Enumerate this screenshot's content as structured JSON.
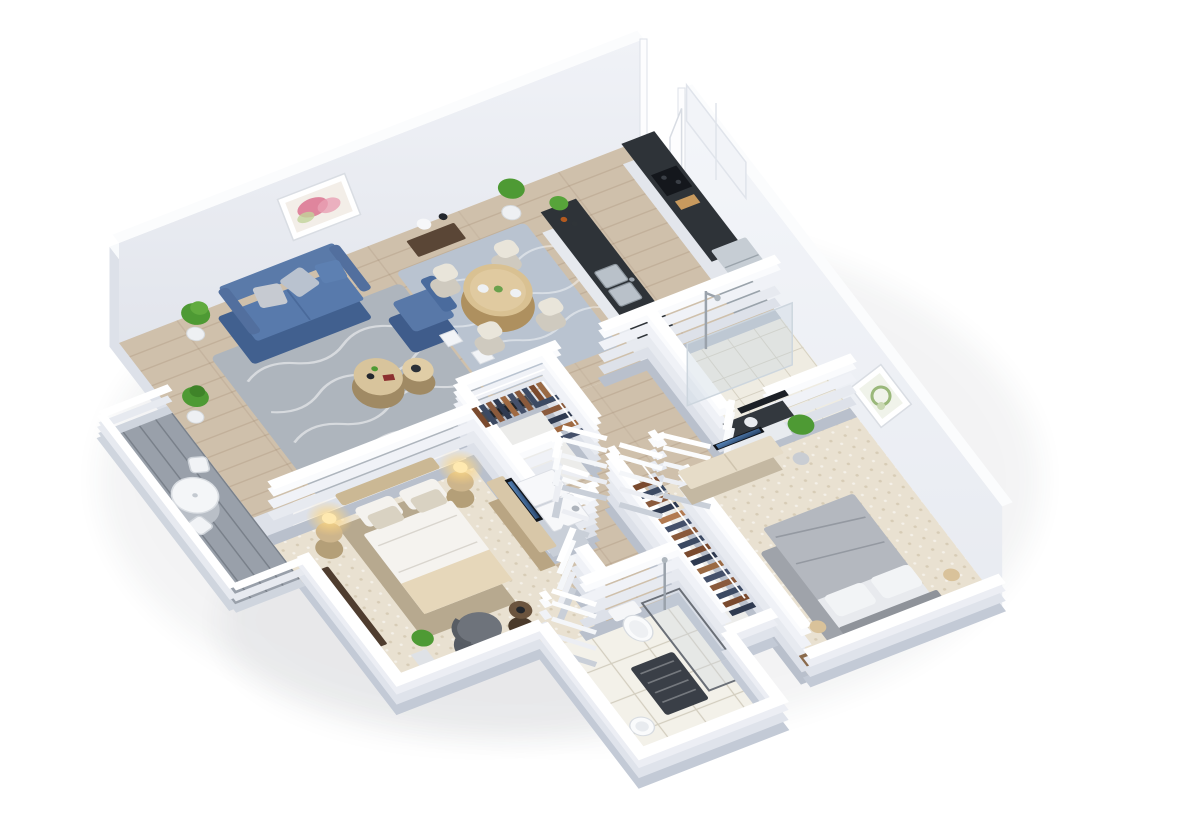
{
  "scene": {
    "type": "3d-isometric-floor-plan-render",
    "title": "Two-bedroom apartment 3D floor plan",
    "background": "#ffffff",
    "text_on_screen": "none"
  },
  "palette": {
    "wall_top": "#ffffff",
    "wall_face_far": "#e9ebf1",
    "wall_face_right": "#f0f2f6",
    "wall_face_shadow": "#dde1e9",
    "wood_floor": "#cfc0ab",
    "deck_gray": "#99a0aa",
    "carpet_beige": "#e9e1d1",
    "tile_white": "#f3f1e9",
    "rug_gray": "#aeb5bd",
    "rug_dining": "#b9c3d0",
    "sofa_blue": "#5878a8",
    "sofa_blue_dark": "#41608f",
    "counter_dark": "#2e3338",
    "steel": "#9aa3ab",
    "wood_light": "#d9c192",
    "wood_walnut": "#5a4636",
    "clothes_brown": "#8a5a3c",
    "clothes_navy": "#3c4a63",
    "lamp_glow": "#ffd98a",
    "plant_green": "#4e9a34",
    "bed2_gray": "#b4b8bf",
    "bed_master_white": "#f5f3ef",
    "throw_beige": "#e6d7ba",
    "headboard_tan": "#cbb894"
  },
  "rooms": {
    "living": {
      "name": "Living room",
      "furniture": [
        "blue-sofa",
        "blue-armchair",
        "nesting-coffee-tables",
        "gray-wave-rug",
        "wall-art-abstract",
        "potted-plants",
        "console-table-with-lamp",
        "media-fireplace-unit",
        "decor-columns"
      ]
    },
    "dining": {
      "name": "Dining area",
      "furniture": [
        "round-dining-table",
        "four-cream-chairs",
        "blue-gray-rug",
        "corner-planters"
      ]
    },
    "kitchen": {
      "name": "Kitchen",
      "furniture": [
        "dark-countertop-run",
        "cooktop",
        "cutting-board",
        "stainless-fridge",
        "peninsula-with-double-sink",
        "bottles",
        "counter-plant",
        "upper-cabinets"
      ]
    },
    "entry": {
      "name": "Entry",
      "furniture": [
        "open-entry-door"
      ]
    },
    "bathroom1": {
      "name": "Bathroom with walk-in shower",
      "furniture": [
        "glass-shower-screen",
        "shower-fixture",
        "vanity-dark-top",
        "mirror"
      ]
    },
    "hallway": {
      "name": "Hallway",
      "furniture": [
        "white-interior-doors"
      ]
    },
    "closet": {
      "name": "Master walk-in closet",
      "furniture": [
        "hanging-clothes-two-rods"
      ]
    },
    "laundry": {
      "name": "Laundry closet",
      "furniture": [
        "washer",
        "dryer",
        "bifold-doors"
      ]
    },
    "master": {
      "name": "Master bedroom",
      "furniture": [
        "upholstered-bed",
        "two-drum-nightstands",
        "glowing-table-lamps",
        "gray-armchair",
        "round-side-table",
        "dark-sideboard",
        "tv-console",
        "potted-plant"
      ]
    },
    "bedroom2": {
      "name": "Second bedroom",
      "furniture": [
        "gray-bed",
        "two-nightstands-with-lamps",
        "tv-console-with-tv",
        "potted-plant",
        "round-wall-art"
      ]
    },
    "closet2": {
      "name": "Second bedroom closet",
      "furniture": [
        "hanging-clothes-rod"
      ]
    },
    "bathroom2": {
      "name": "Main bathroom",
      "furniture": [
        "toilet",
        "pedestal-sink",
        "glass-shower",
        "dark-bath-mat"
      ]
    },
    "balcony": {
      "name": "Balcony",
      "furniture": [
        "bistro-table",
        "two-folding-chairs",
        "white-railing",
        "sliding-glass-door"
      ]
    }
  }
}
